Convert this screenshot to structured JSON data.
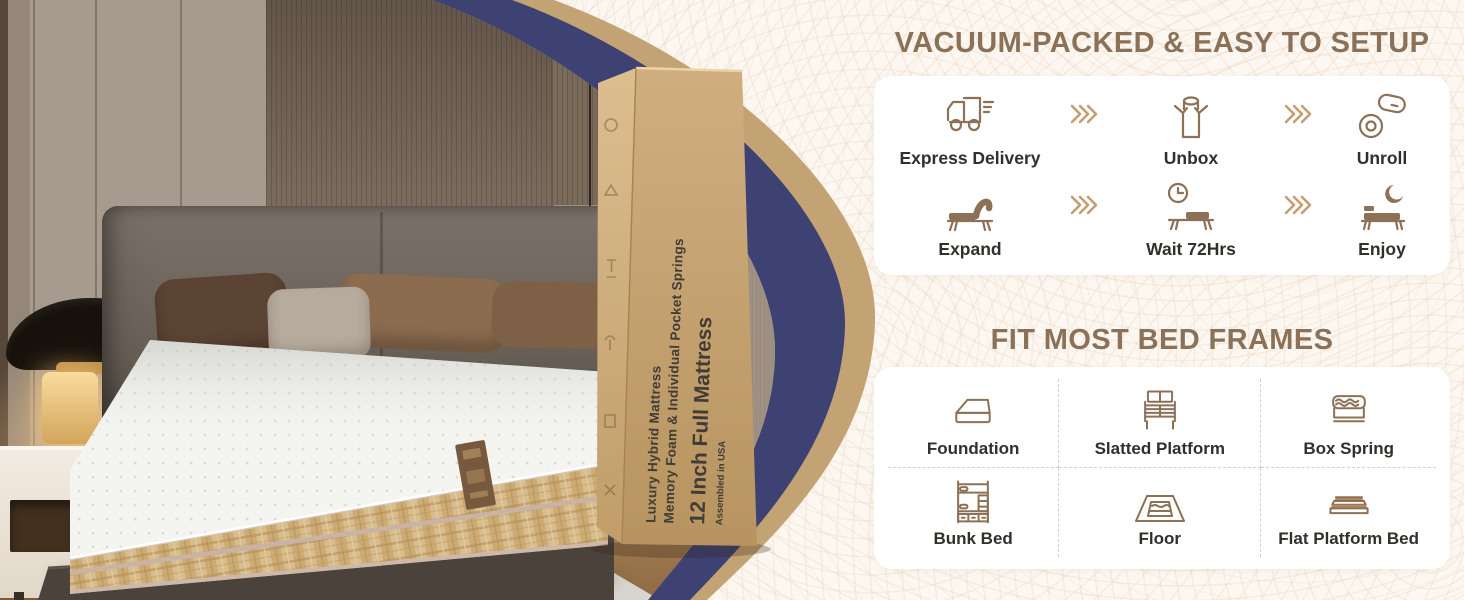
{
  "theme": {
    "cream_bg": "#fcf7f0",
    "pattern_line": "#e2c9b2",
    "heading_color": "#8a7158",
    "navy_ring": "#3e4273",
    "tan_ring": "#c3a374",
    "card_bg": "#ffffff",
    "icon_stroke": "#8c7157",
    "icon_fill": "#8c7157",
    "label_color": "#332f2a",
    "arrow_color": "#c59e72",
    "box_face": "#c7a577"
  },
  "box": {
    "line1": "Luxury Hybrid Mattress",
    "line2": "Memory Foam & Individual Pocket Springs",
    "title": "12 Inch Full Mattress",
    "origin": "Assembled in USA"
  },
  "setup": {
    "title": "VACUUM-PACKED & EASY TO SETUP",
    "steps": [
      {
        "label": "Express Delivery",
        "icon": "delivery-truck-icon"
      },
      {
        "label": "Unbox",
        "icon": "unbox-icon"
      },
      {
        "label": "Unroll",
        "icon": "unroll-icon"
      },
      {
        "label": "Expand",
        "icon": "expand-icon"
      },
      {
        "label": "Wait 72Hrs",
        "icon": "clock-bed-icon"
      },
      {
        "label": "Enjoy",
        "icon": "sleep-moon-icon"
      }
    ]
  },
  "frames": {
    "title": "FIT MOST BED FRAMES",
    "items": [
      {
        "label": "Foundation",
        "icon": "foundation-icon"
      },
      {
        "label": "Slatted Platform",
        "icon": "slatted-platform-icon"
      },
      {
        "label": "Box Spring",
        "icon": "box-spring-icon"
      },
      {
        "label": "Bunk Bed",
        "icon": "bunk-bed-icon"
      },
      {
        "label": "Floor",
        "icon": "floor-icon"
      },
      {
        "label": "Flat Platform Bed",
        "icon": "flat-platform-icon"
      }
    ]
  }
}
